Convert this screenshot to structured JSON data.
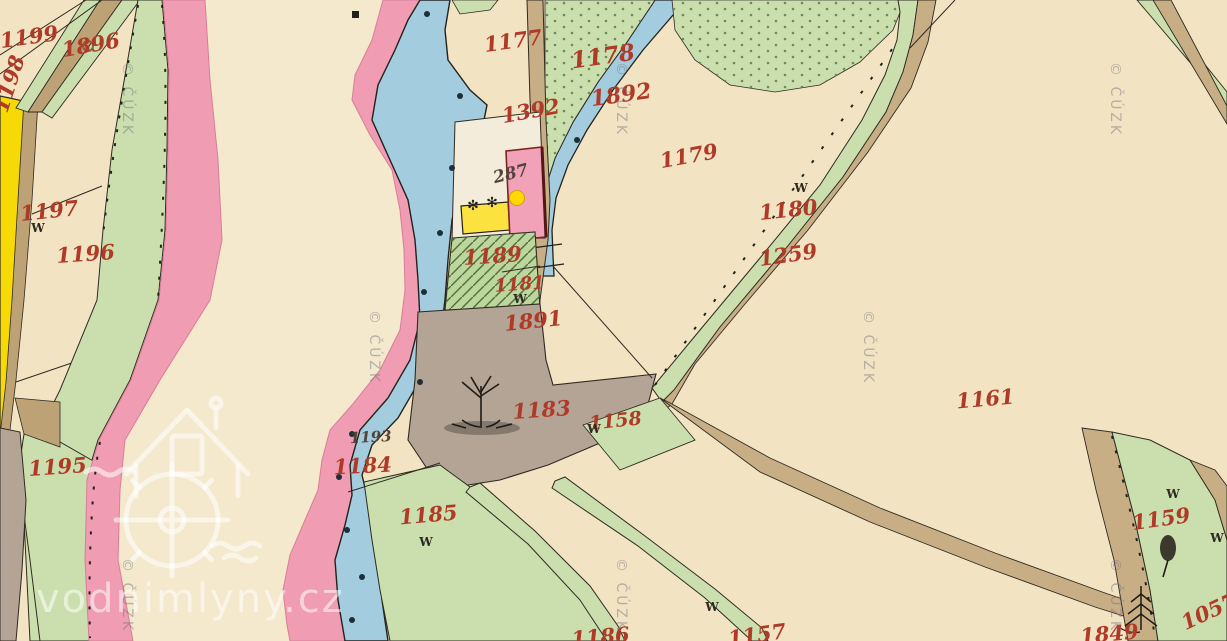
{
  "watermark": {
    "site": "vodnimlyny.cz",
    "copyright": "© ČÚZK"
  },
  "symbols": {
    "meadow": "W",
    "garden_tree": "✻"
  },
  "poi": {
    "marker_color": "#ffd800",
    "building_number": "287"
  },
  "colors": {
    "paper": "#f2e3c2",
    "meander_field": "#f4e8cd",
    "meadow_green": "#cadfad",
    "garden_green": "#bcd69d",
    "water_blue": "#a3ccdf",
    "bank_pink": "#f09cb2",
    "road_tan": "#c8ae85",
    "pasture_grey": "#b3a496",
    "field_yellow": "#f6d905",
    "building_pink": "#f1a2b8",
    "building_yellow": "#fce23e",
    "label_red": "#b03a28",
    "label_dark": "#54433a"
  },
  "labels": [
    {
      "text": "1199",
      "color": "#b03a28"
    },
    {
      "text": "1896",
      "color": "#b03a28"
    },
    {
      "text": "1198",
      "color": "#b03a28"
    },
    {
      "text": "1197",
      "color": "#b03a28"
    },
    {
      "text": "1196",
      "color": "#b03a28"
    },
    {
      "text": "1195",
      "color": "#b03a28"
    },
    {
      "text": "1177",
      "color": "#b03a28"
    },
    {
      "text": "1178",
      "color": "#b03a28"
    },
    {
      "text": "1392",
      "color": "#b03a28"
    },
    {
      "text": "1892",
      "color": "#b03a28"
    },
    {
      "text": "1179",
      "color": "#b03a28"
    },
    {
      "text": "1180",
      "color": "#b03a28"
    },
    {
      "text": "1259",
      "color": "#b03a28"
    },
    {
      "text": "1161",
      "color": "#b03a28"
    },
    {
      "text": "1189",
      "color": "#b03a28"
    },
    {
      "text": "1181",
      "color": "#b03a28"
    },
    {
      "text": "1891",
      "color": "#b03a28"
    },
    {
      "text": "1183",
      "color": "#b03a28"
    },
    {
      "text": "1158",
      "color": "#b03a28"
    },
    {
      "text": "1193",
      "color": "#54433a"
    },
    {
      "text": "1184",
      "color": "#b03a28"
    },
    {
      "text": "1185",
      "color": "#b03a28"
    },
    {
      "text": "1159",
      "color": "#b03a28"
    },
    {
      "text": "1849",
      "color": "#b03a28"
    },
    {
      "text": "1057",
      "color": "#b03a28"
    },
    {
      "text": "1186",
      "color": "#b03a28"
    },
    {
      "text": "1157",
      "color": "#b03a28"
    },
    {
      "text": "287",
      "color": "#54433a"
    }
  ]
}
